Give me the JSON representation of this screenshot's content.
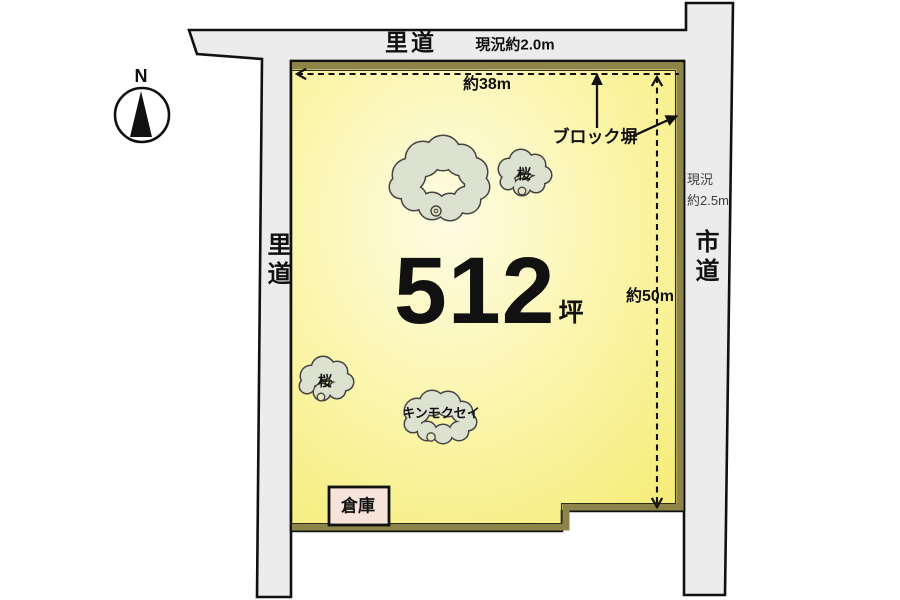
{
  "diagram": {
    "compass": {
      "north": "N"
    },
    "roads": {
      "top": {
        "name": "里道",
        "width_note": "現況約2.0m"
      },
      "left": {
        "name": "里道"
      },
      "right": {
        "name": "市道",
        "width_line1": "現況",
        "width_line2": "約2.5m"
      }
    },
    "parcel": {
      "area_value": "512",
      "area_unit": "坪",
      "frontage_label": "約38m",
      "depth_label": "約50m",
      "block_wall_label": "ブロック塀"
    },
    "features": {
      "warehouse_label": "倉庫",
      "tree_sakura_top": "桜",
      "tree_sakura_left": "桜",
      "tree_kinmokusei": "キンモクセイ"
    },
    "colors": {
      "road_fill": "#ececec",
      "outline": "#111111",
      "parcel_edge": "#f4ea6c",
      "parcel_mid": "#fbf5ab",
      "parcel_center": "#fefce4",
      "wall": "#8d8449",
      "warehouse_fill": "#f7e3da",
      "tree_fill": "#dde2d0"
    }
  }
}
